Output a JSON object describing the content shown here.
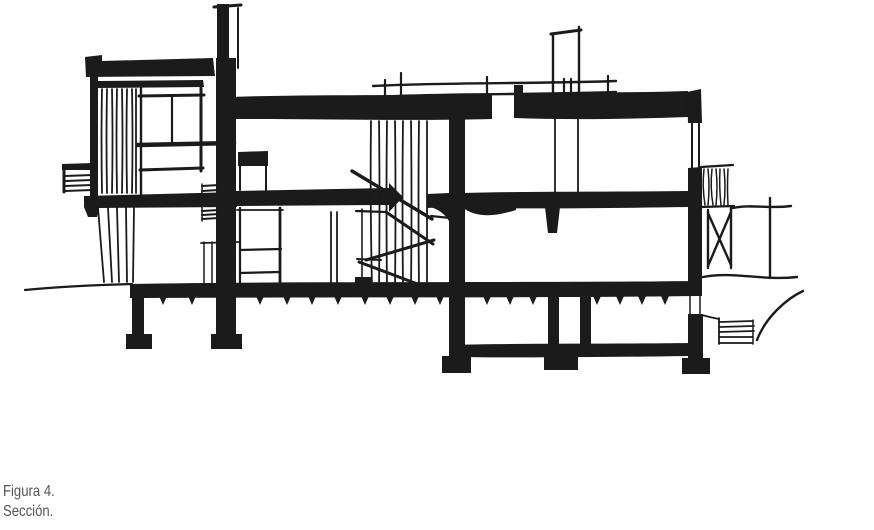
{
  "figure": {
    "label": "Figura 4.",
    "caption": "Sección.",
    "drawing": "hand-drawn-building-cross-section-sketch"
  },
  "colors": {
    "background": "#ffffff",
    "ink": "#1b1b1b",
    "caption_text": "#55565a"
  }
}
